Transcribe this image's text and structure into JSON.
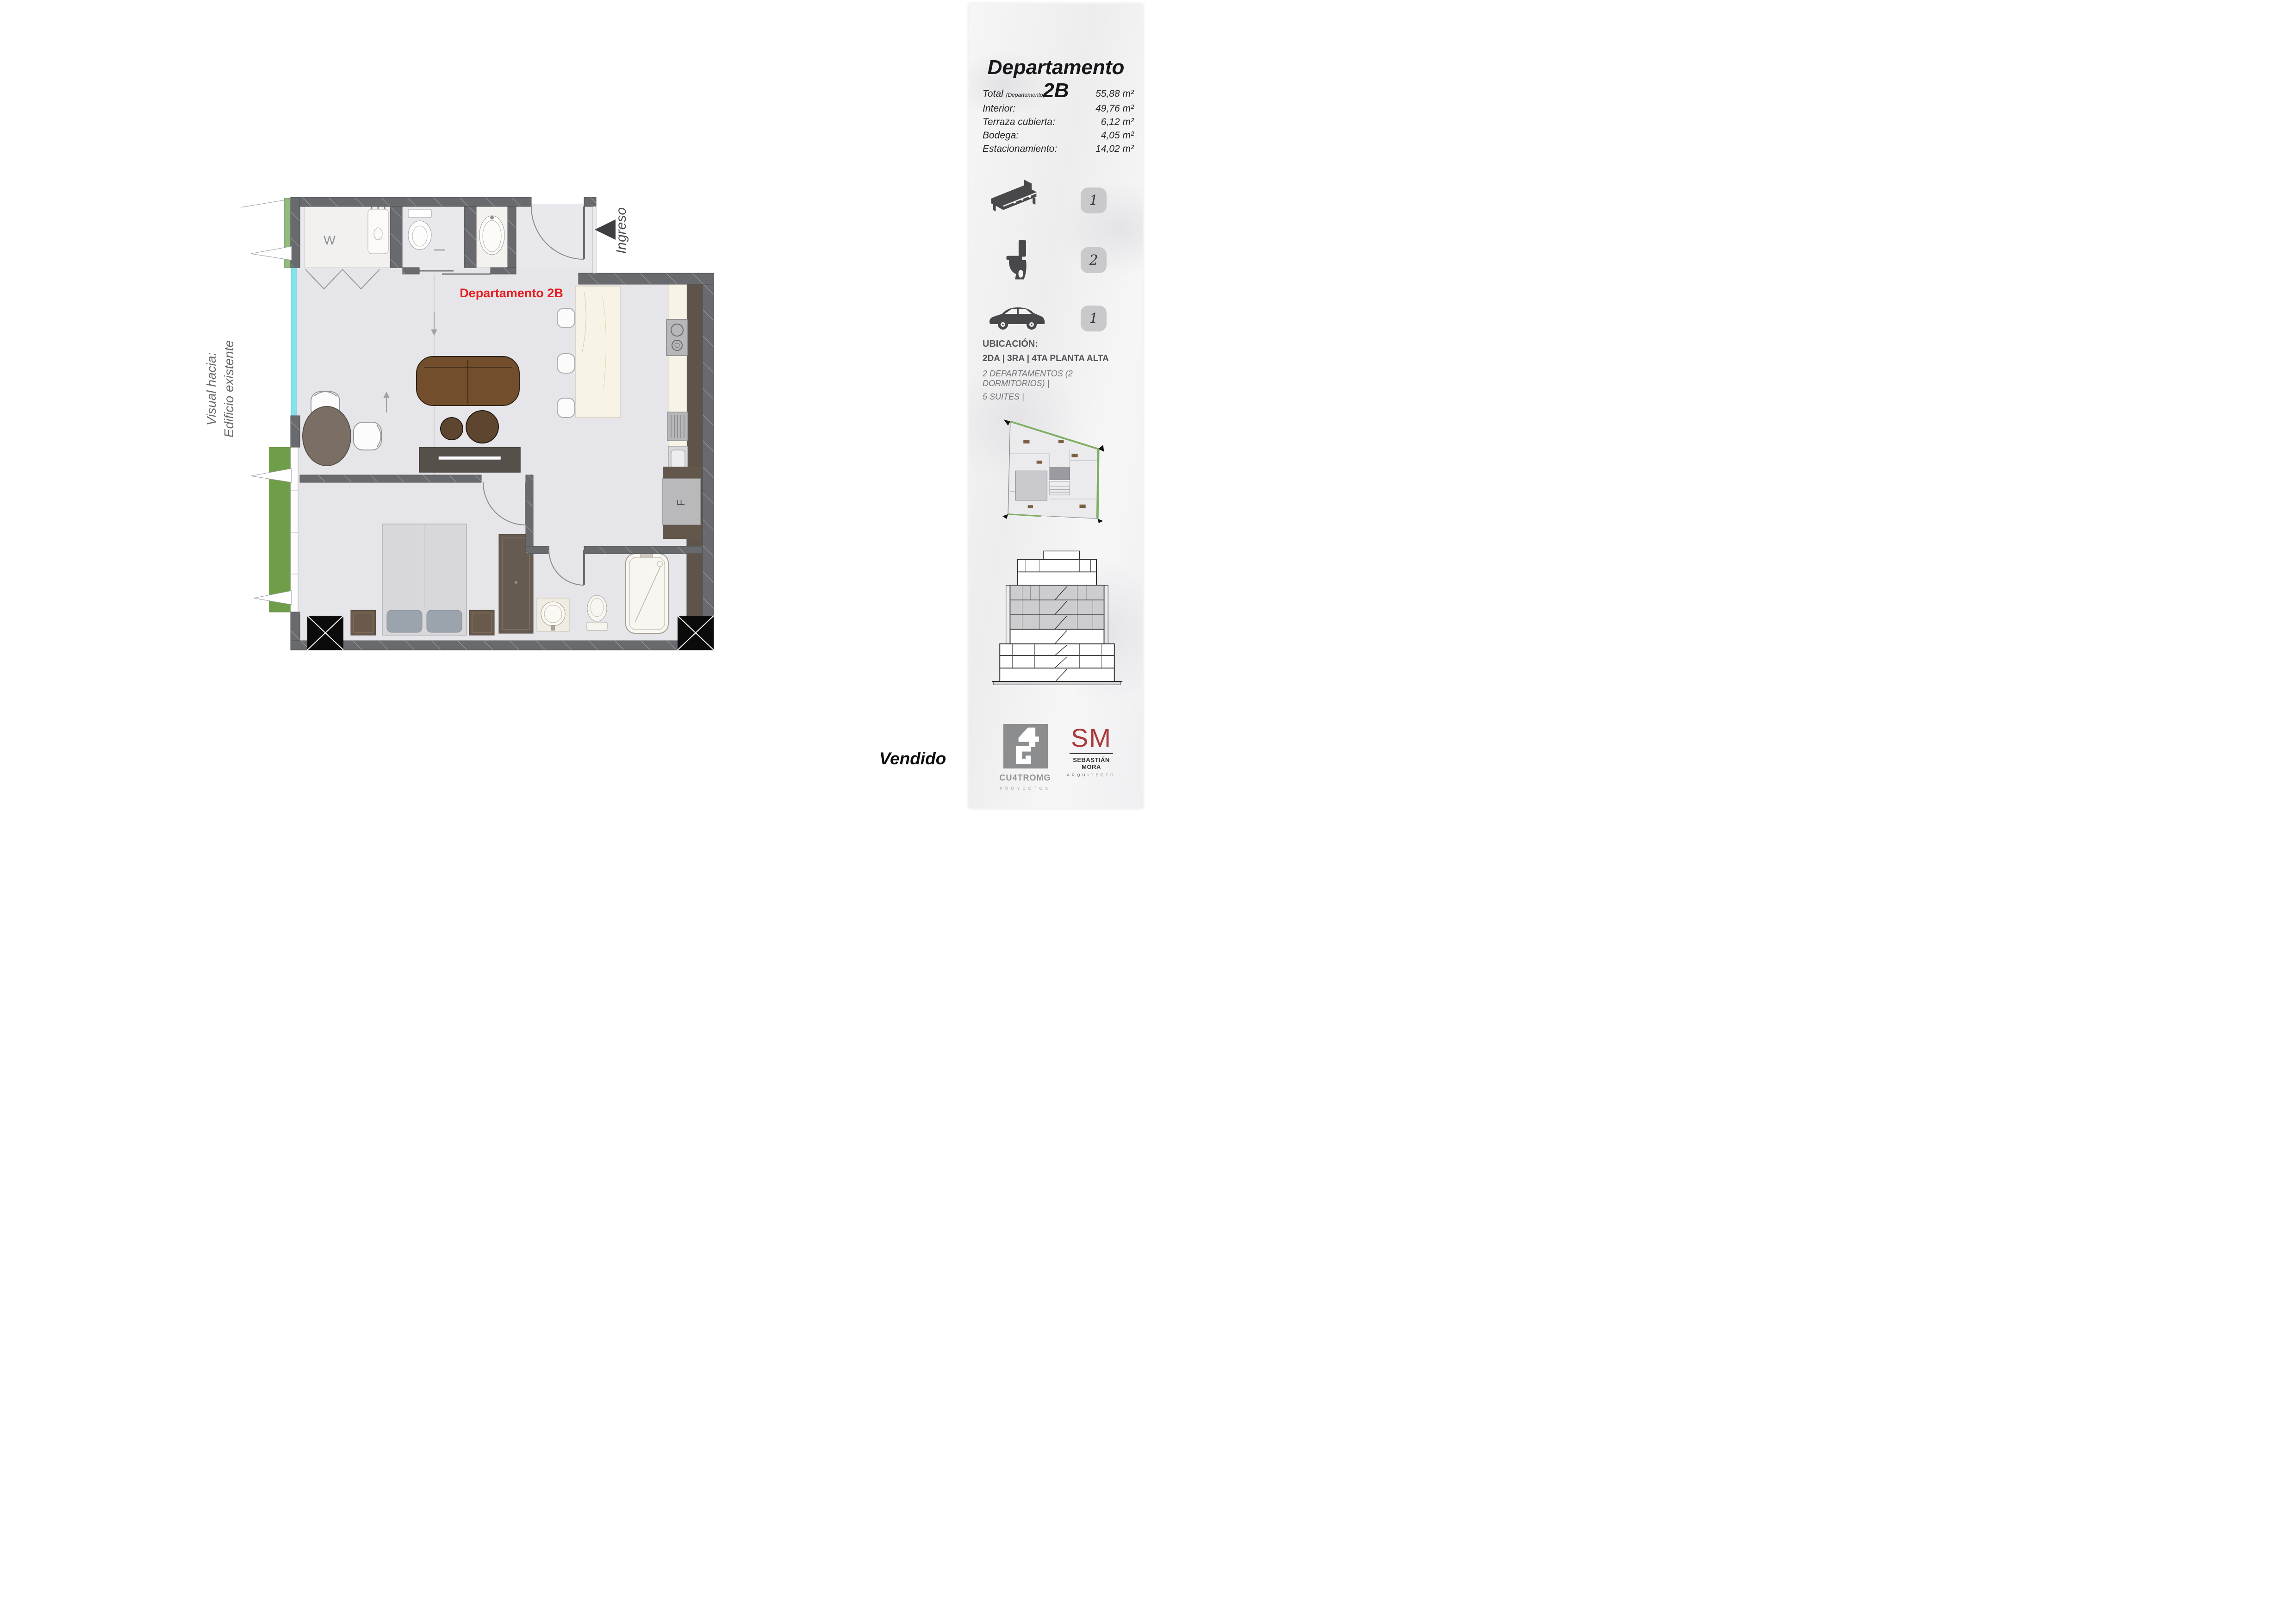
{
  "page": {
    "sold_label": "Vendido"
  },
  "sidebar": {
    "title_line1": "Departamento",
    "title_line2": "2B",
    "specs": [
      {
        "label": "Total ",
        "note": "(Departamento)",
        "colon": ":",
        "value": "55,88 m²"
      },
      {
        "label": "Interior:",
        "value": "49,76 m²"
      },
      {
        "label": "Terraza cubierta:",
        "value": "6,12 m²"
      },
      {
        "label": "Bodega:",
        "value": "4,05 m²"
      },
      {
        "label": "Estacionamiento:",
        "value": "14,02 m²"
      }
    ],
    "features": [
      {
        "icon": "bed-icon",
        "count": "1"
      },
      {
        "icon": "toilet-icon",
        "count": "2"
      },
      {
        "icon": "car-icon",
        "count": "1"
      }
    ],
    "ubicacion": {
      "heading": "UBICACIÓN:",
      "line1": "2DA | 3RA | 4TA PLANTA ALTA",
      "line2": "2 DEPARTAMENTOS (2 DORMITORIOS) |",
      "line3": "5 SUITES |"
    },
    "logos": {
      "cu4tromg": {
        "name": "CU4TROMG",
        "tagline": "PROYECTOS"
      },
      "sm": {
        "initials": "SM",
        "name": "SEBASTIÁN MORA",
        "tagline": "ARQUITECTO"
      }
    }
  },
  "plan": {
    "unit_label": "Departamento 2B",
    "entrance_label": "Ingreso",
    "view_label_line1": "Visual hacia:",
    "view_label_line2": "Edificio existente",
    "closet_label": "W",
    "fridge_label": "F"
  },
  "colors": {
    "unit_label_red": "#e61e1e",
    "sm_red": "#a93a3c",
    "wall_gray": "#696a6e",
    "accent_green": "#6f9e49",
    "glass_cyan": "#7fe5ec"
  }
}
